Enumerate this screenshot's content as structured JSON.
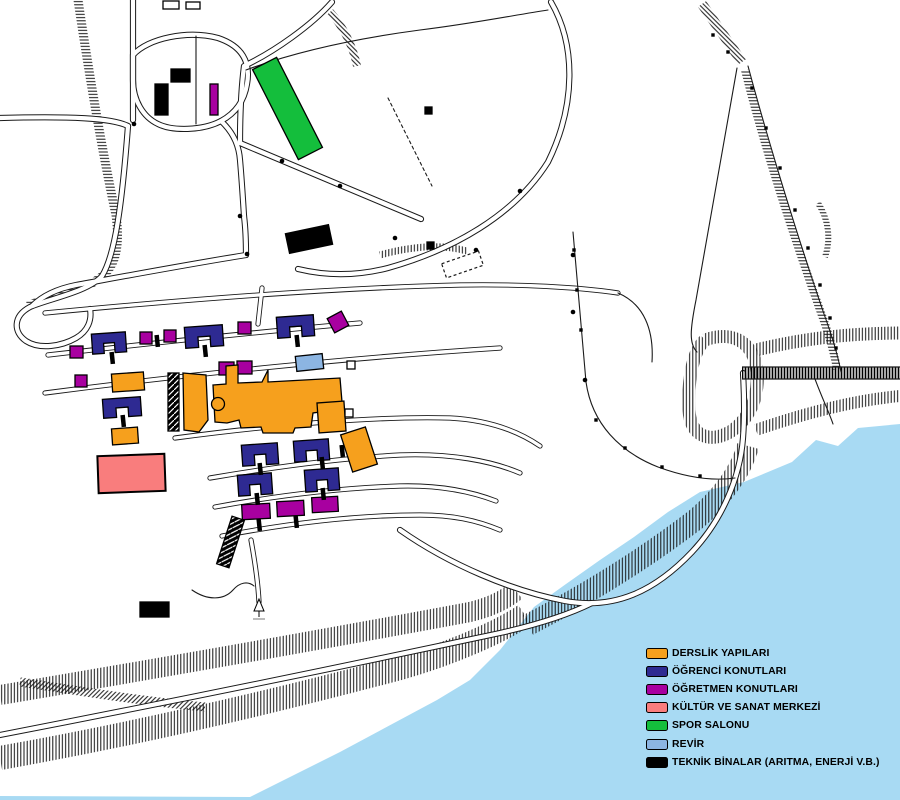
{
  "legend": {
    "items": [
      {
        "key": "derslik",
        "label": "DERSLİK YAPILARI",
        "color": "#F6A01D"
      },
      {
        "key": "ogrenci",
        "label": "ÖĞRENCİ KONUTLARI",
        "color": "#2E2A92"
      },
      {
        "key": "ogretmen",
        "label": "ÖĞRETMEN KONUTLARI",
        "color": "#A800A0"
      },
      {
        "key": "kultur",
        "label": "KÜLTÜR VE SANAT MERKEZİ",
        "color": "#F97D7D"
      },
      {
        "key": "spor",
        "label": "SPOR SALONU",
        "color": "#14BE3C"
      },
      {
        "key": "revir",
        "label": "REVİR",
        "color": "#8CB5E2"
      },
      {
        "key": "teknik",
        "label": "TEKNİK BİNALAR (ARITMA, ENERJİ V.B.)",
        "color": "#000000"
      }
    ]
  },
  "map": {
    "water_color": "#A8DAF3",
    "land_color": "#FFFFFF",
    "line_color": "#000000",
    "water_polygon": "900,424 858,428 838,446 816,440 792,462 768,472 744,482 700,492 668,512 634,537 600,560 566,584 534,607 500,650 470,680 437,700 340,752 250,797 0,796 0,800 900,800",
    "buildings": [
      {
        "key": "spor",
        "shape": "rect",
        "x": 274,
        "y": 58,
        "w": 27,
        "h": 101,
        "rot": -27
      },
      {
        "key": "teknik",
        "shape": "rect",
        "x": 155,
        "y": 84,
        "w": 13,
        "h": 31
      },
      {
        "key": "teknik",
        "shape": "rect",
        "x": 171,
        "y": 69,
        "w": 19,
        "h": 13
      },
      {
        "key": "ogretmen",
        "shape": "rect",
        "x": 210,
        "y": 84,
        "w": 8,
        "h": 31
      },
      {
        "key": "teknik",
        "shape": "rect",
        "x": 287,
        "y": 229,
        "w": 44,
        "h": 20,
        "rot": -12
      },
      {
        "key": "teknik",
        "shape": "rect",
        "x": 140,
        "y": 602,
        "w": 29,
        "h": 15
      },
      {
        "key": "teknik",
        "shape": "rect",
        "x": 427,
        "y": 242,
        "w": 7,
        "h": 7
      },
      {
        "key": "teknik",
        "shape": "rect",
        "x": 425,
        "y": 107,
        "w": 7,
        "h": 7
      },
      {
        "key": "teknik",
        "shape": "stairs",
        "x": 168,
        "y": 373,
        "w": 11,
        "h": 58
      },
      {
        "key": "teknik",
        "shape": "stairs",
        "x": 224,
        "y": 517,
        "w": 13,
        "h": 50,
        "rot": 18
      },
      {
        "key": "ogretmen",
        "shape": "rect",
        "x": 70,
        "y": 346,
        "w": 13,
        "h": 12
      },
      {
        "key": "ogretmen",
        "shape": "rect",
        "x": 140,
        "y": 332,
        "w": 12,
        "h": 12
      },
      {
        "key": "ogretmen",
        "shape": "rect",
        "x": 164,
        "y": 330,
        "w": 12,
        "h": 12
      },
      {
        "key": "ogretmen",
        "shape": "rect",
        "x": 238,
        "y": 322,
        "w": 13,
        "h": 12
      },
      {
        "key": "ogretmen",
        "shape": "rect",
        "x": 330,
        "y": 314,
        "w": 16,
        "h": 16,
        "rot": -28
      },
      {
        "key": "ogretmen",
        "shape": "rect",
        "x": 75,
        "y": 375,
        "w": 12,
        "h": 12
      },
      {
        "key": "ogretmen",
        "shape": "rect",
        "x": 219,
        "y": 362,
        "w": 15,
        "h": 13
      },
      {
        "key": "ogretmen",
        "shape": "rect",
        "x": 237,
        "y": 361,
        "w": 15,
        "h": 13
      },
      {
        "key": "ogretmen",
        "shape": "rect",
        "x": 242,
        "y": 504,
        "w": 28,
        "h": 15,
        "rot": -3
      },
      {
        "key": "ogretmen",
        "shape": "rect",
        "x": 277,
        "y": 501,
        "w": 27,
        "h": 15,
        "rot": -3
      },
      {
        "key": "ogretmen",
        "shape": "rect",
        "x": 312,
        "y": 497,
        "w": 26,
        "h": 15,
        "rot": -3
      },
      {
        "key": "ogrenci",
        "shape": "u",
        "x": 92,
        "y": 333,
        "w": 34,
        "h": 20
      },
      {
        "key": "ogrenci",
        "shape": "u",
        "x": 185,
        "y": 326,
        "w": 38,
        "h": 21
      },
      {
        "key": "ogrenci",
        "shape": "u",
        "x": 277,
        "y": 316,
        "w": 37,
        "h": 21
      },
      {
        "key": "ogrenci",
        "shape": "u",
        "x": 103,
        "y": 398,
        "w": 38,
        "h": 19
      },
      {
        "key": "ogrenci",
        "shape": "u",
        "x": 242,
        "y": 444,
        "w": 36,
        "h": 21
      },
      {
        "key": "ogrenci",
        "shape": "u",
        "x": 294,
        "y": 440,
        "w": 35,
        "h": 21
      },
      {
        "key": "ogrenci",
        "shape": "u",
        "x": 238,
        "y": 474,
        "w": 34,
        "h": 21
      },
      {
        "key": "ogrenci",
        "shape": "u",
        "x": 305,
        "y": 469,
        "w": 34,
        "h": 22
      },
      {
        "key": "derslik",
        "shape": "rect",
        "x": 112,
        "y": 373,
        "w": 32,
        "h": 18,
        "rot": -4
      },
      {
        "key": "derslik",
        "shape": "rect",
        "x": 112,
        "y": 428,
        "w": 26,
        "h": 16,
        "rot": -4
      },
      {
        "key": "derslik",
        "shape": "rect",
        "x": 346,
        "y": 430,
        "w": 26,
        "h": 39,
        "rot": -18
      },
      {
        "key": "derslik",
        "shape": "poly",
        "points": "213,385 226,384 226,366 238,365 238,383 262,382 268,370 268,382 340,378 342,402 334,410 313,413 311,427 295,428 293,433 263,433 261,427 241,428 239,420 227,423 215,422"
      },
      {
        "key": "derslik",
        "shape": "poly",
        "points": "183,373 206,375 208,420 199,432 184,430"
      },
      {
        "key": "derslik",
        "shape": "rect",
        "x": 318,
        "y": 402,
        "w": 27,
        "h": 30,
        "rot": -4
      },
      {
        "key": "derslik",
        "shape": "circle",
        "x": 218,
        "y": 404,
        "r": 6.5
      },
      {
        "key": "kultur",
        "shape": "rect",
        "x": 98,
        "y": 455,
        "w": 67,
        "h": 37,
        "rot": -2
      },
      {
        "key": "revir",
        "shape": "rect",
        "x": 296,
        "y": 355,
        "w": 27,
        "h": 15,
        "rot": -6
      },
      {
        "key": "outline",
        "shape": "outline",
        "x": 347,
        "y": 361,
        "w": 8,
        "h": 8
      },
      {
        "key": "outline",
        "shape": "outline",
        "x": 345,
        "y": 409,
        "w": 8,
        "h": 8
      },
      {
        "key": "outline",
        "shape": "outline",
        "x": 163,
        "y": 1,
        "w": 16,
        "h": 8
      },
      {
        "key": "outline",
        "shape": "outline",
        "x": 186,
        "y": 2,
        "w": 14,
        "h": 7
      }
    ],
    "posts": [
      [
        110,
        352
      ],
      [
        203,
        345
      ],
      [
        295,
        335
      ],
      [
        121,
        415
      ],
      [
        258,
        463
      ],
      [
        320,
        457
      ],
      [
        255,
        493
      ],
      [
        321,
        488
      ],
      [
        257,
        519
      ],
      [
        294,
        516
      ],
      [
        155,
        335
      ],
      [
        340,
        445
      ]
    ],
    "dots": [
      [
        134,
        124
      ],
      [
        240,
        216
      ],
      [
        247,
        254
      ],
      [
        395,
        238
      ],
      [
        476,
        250
      ],
      [
        520,
        191
      ],
      [
        573,
        255
      ],
      [
        573,
        312
      ],
      [
        428,
        110
      ],
      [
        585,
        380
      ],
      [
        282,
        161
      ],
      [
        340,
        186
      ]
    ],
    "fence_posts": [
      [
        574,
        250
      ],
      [
        577,
        290
      ],
      [
        581,
        330
      ],
      [
        596,
        420
      ],
      [
        625,
        448
      ],
      [
        662,
        467
      ],
      [
        700,
        476
      ],
      [
        752,
        88
      ],
      [
        766,
        128
      ],
      [
        780,
        168
      ],
      [
        795,
        210
      ],
      [
        808,
        248
      ],
      [
        820,
        285
      ],
      [
        830,
        318
      ],
      [
        836,
        348
      ],
      [
        713,
        35
      ],
      [
        728,
        52
      ]
    ]
  }
}
